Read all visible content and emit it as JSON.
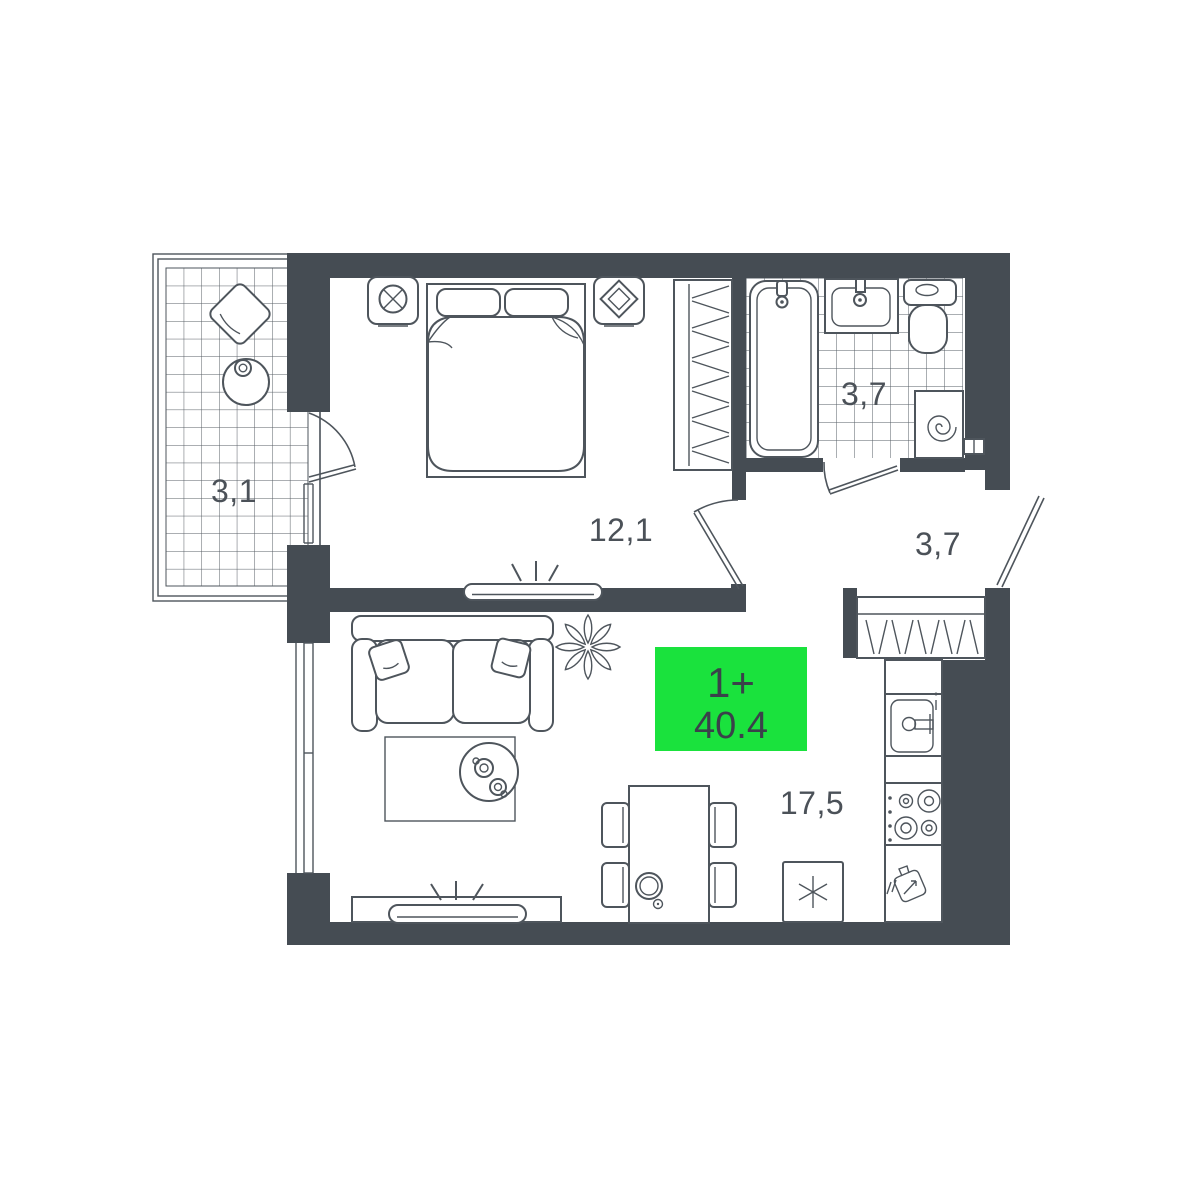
{
  "plan": {
    "type_label": "1+",
    "total_area": "40.4",
    "rooms": [
      {
        "name": "balcony",
        "area": "3,1"
      },
      {
        "name": "bedroom",
        "area": "12,1"
      },
      {
        "name": "bathroom",
        "area": "3,7"
      },
      {
        "name": "hallway",
        "area": "3,7"
      },
      {
        "name": "living-kitchen",
        "area": "17,5"
      }
    ]
  },
  "colors": {
    "wall": "#454c53",
    "furniture_line": "#4e555c",
    "label_text": "#4b5158",
    "badge_green": "#1ae23d",
    "badge_text": "#3a414a",
    "background": "#ffffff"
  },
  "icons": {
    "washing_machine": "spiral-drum",
    "fridge": "snowflake-asterisk",
    "tv": "light-rays",
    "wardrobe": "hanger-hatching",
    "bedside_fan": "crossed-circle",
    "kettle": "pitcher-with-motion-lines"
  }
}
